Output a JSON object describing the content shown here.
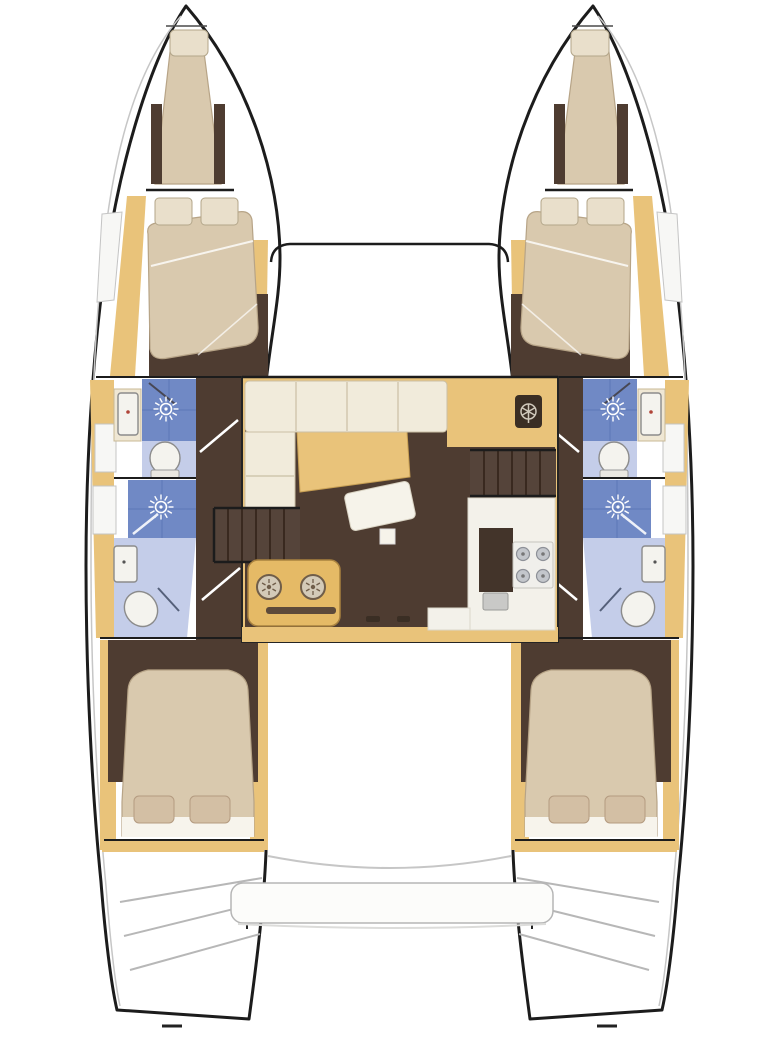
{
  "plan": {
    "type": "catamaran-layout-floorplan",
    "symmetry": "port and starboard hulls are mirror images",
    "port_hull": {
      "bow_berth": {
        "fixtures": [
          "single-berth",
          "pillow"
        ]
      },
      "forward_cabin": {
        "fixtures": [
          "double-berth",
          "pillow",
          "pillow"
        ]
      },
      "forward_head": {
        "fixtures": [
          "washbasin",
          "shower-sunburst-icon",
          "toilet"
        ]
      },
      "aft_head": {
        "fixtures": [
          "shower-sunburst-icon",
          "washbasin",
          "toilet"
        ]
      },
      "aft_cabin": {
        "fixtures": [
          "double-berth",
          "pillow",
          "pillow"
        ]
      },
      "transom": {
        "fixtures": [
          "boarding-steps"
        ]
      }
    },
    "starboard_hull": "mirror-of-port-hull",
    "foredeck": {
      "fixtures": [
        "forward-crossbeam"
      ]
    },
    "saloon": {
      "fixtures": [
        "l-shaped-sofa",
        "table",
        "chaise-seat",
        "nav-helm-seat",
        "stairs-to-port-hull",
        "stairs-to-starboard-hull",
        "galley-double-round-sink",
        "stove-4-burner",
        "galley-sink",
        "galley-counter",
        "sliding-door-handles"
      ]
    },
    "cockpit": {
      "fixtures": [
        "aft-bench"
      ]
    }
  },
  "palette": {
    "bg": "#ffffff",
    "outline": "#1c1c1c",
    "wood": "#e9c37a",
    "wood_dark": "#d9a95e",
    "floor_dark": "#4e3c31",
    "mattress": "#d9c9ae",
    "mattress_edge": "#b7a487",
    "pillow": "#e9dfcb",
    "pillow_tan": "#d3bfa4",
    "sofa": "#f1ebdb",
    "sofa_seam": "#cabfa5",
    "shower_tile": "#7089c5",
    "bath_floor": "#c4cde9",
    "fixture_white": "#f4f3ee",
    "fixture_line": "#8b8b8b",
    "deck_line": "#c6c6c6",
    "counter_white": "#f3f1ea",
    "steps_dark": "#55443a",
    "galley_unit": "#e5ba66",
    "bench_white": "#fcfcfa"
  }
}
